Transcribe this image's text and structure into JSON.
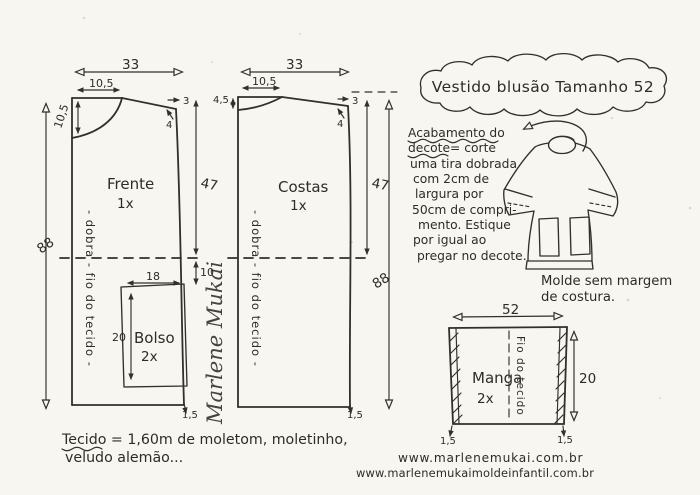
{
  "title": "Vestido blusão Tamanho 52",
  "front_piece": {
    "label": "Frente",
    "cut": "1x",
    "grainline": "- dobra -  fio do tecido -",
    "m": {
      "top_width": "33",
      "neck_width": "10,5",
      "neck_depth": "10,5",
      "shoulder_drop": "3",
      "shoulder_slant": "4",
      "side_length": "47",
      "total_length": "88",
      "pocket_offset": "10",
      "hem_extra": "1,5"
    },
    "pocket": {
      "label": "Bolso",
      "cut": "2x",
      "width": "18",
      "height": "20"
    }
  },
  "back_piece": {
    "label": "Costas",
    "cut": "1x",
    "grainline": "- dobra -  fio do tecido -",
    "m": {
      "top_width": "33",
      "neck_width": "10,5",
      "neck_depth": "4,5",
      "shoulder_drop": "3",
      "shoulder_slant": "4",
      "side_length": "47",
      "total_length": "88",
      "hem_extra": "1,5"
    }
  },
  "sleeve_piece": {
    "label": "Manga",
    "cut": "2x",
    "grainline": "Fio do tecido",
    "m": {
      "width": "52",
      "length": "20",
      "hem_extra_left": "1,5",
      "hem_extra_right": "1,5"
    }
  },
  "instructions": {
    "lines": [
      "Acabamento do",
      "decote= corte",
      "uma tira dobrada",
      "com 2cm de",
      "largura por",
      "50cm de compri-",
      "mento. Estique",
      "por igual ao",
      "pregar no decote."
    ]
  },
  "garment_note": {
    "line1": "Molde sem margem",
    "line2": "de costura."
  },
  "fabric_note": {
    "line1": "Tecido = 1,60m de  moletom, moletinho,",
    "line2": "veludo alemão..."
  },
  "websites": {
    "line1": "www.marlenemukai.com.br",
    "line2": "www.marlenemukaimoldeinfantil.com.br"
  },
  "signature": "Marlene Mukai"
}
